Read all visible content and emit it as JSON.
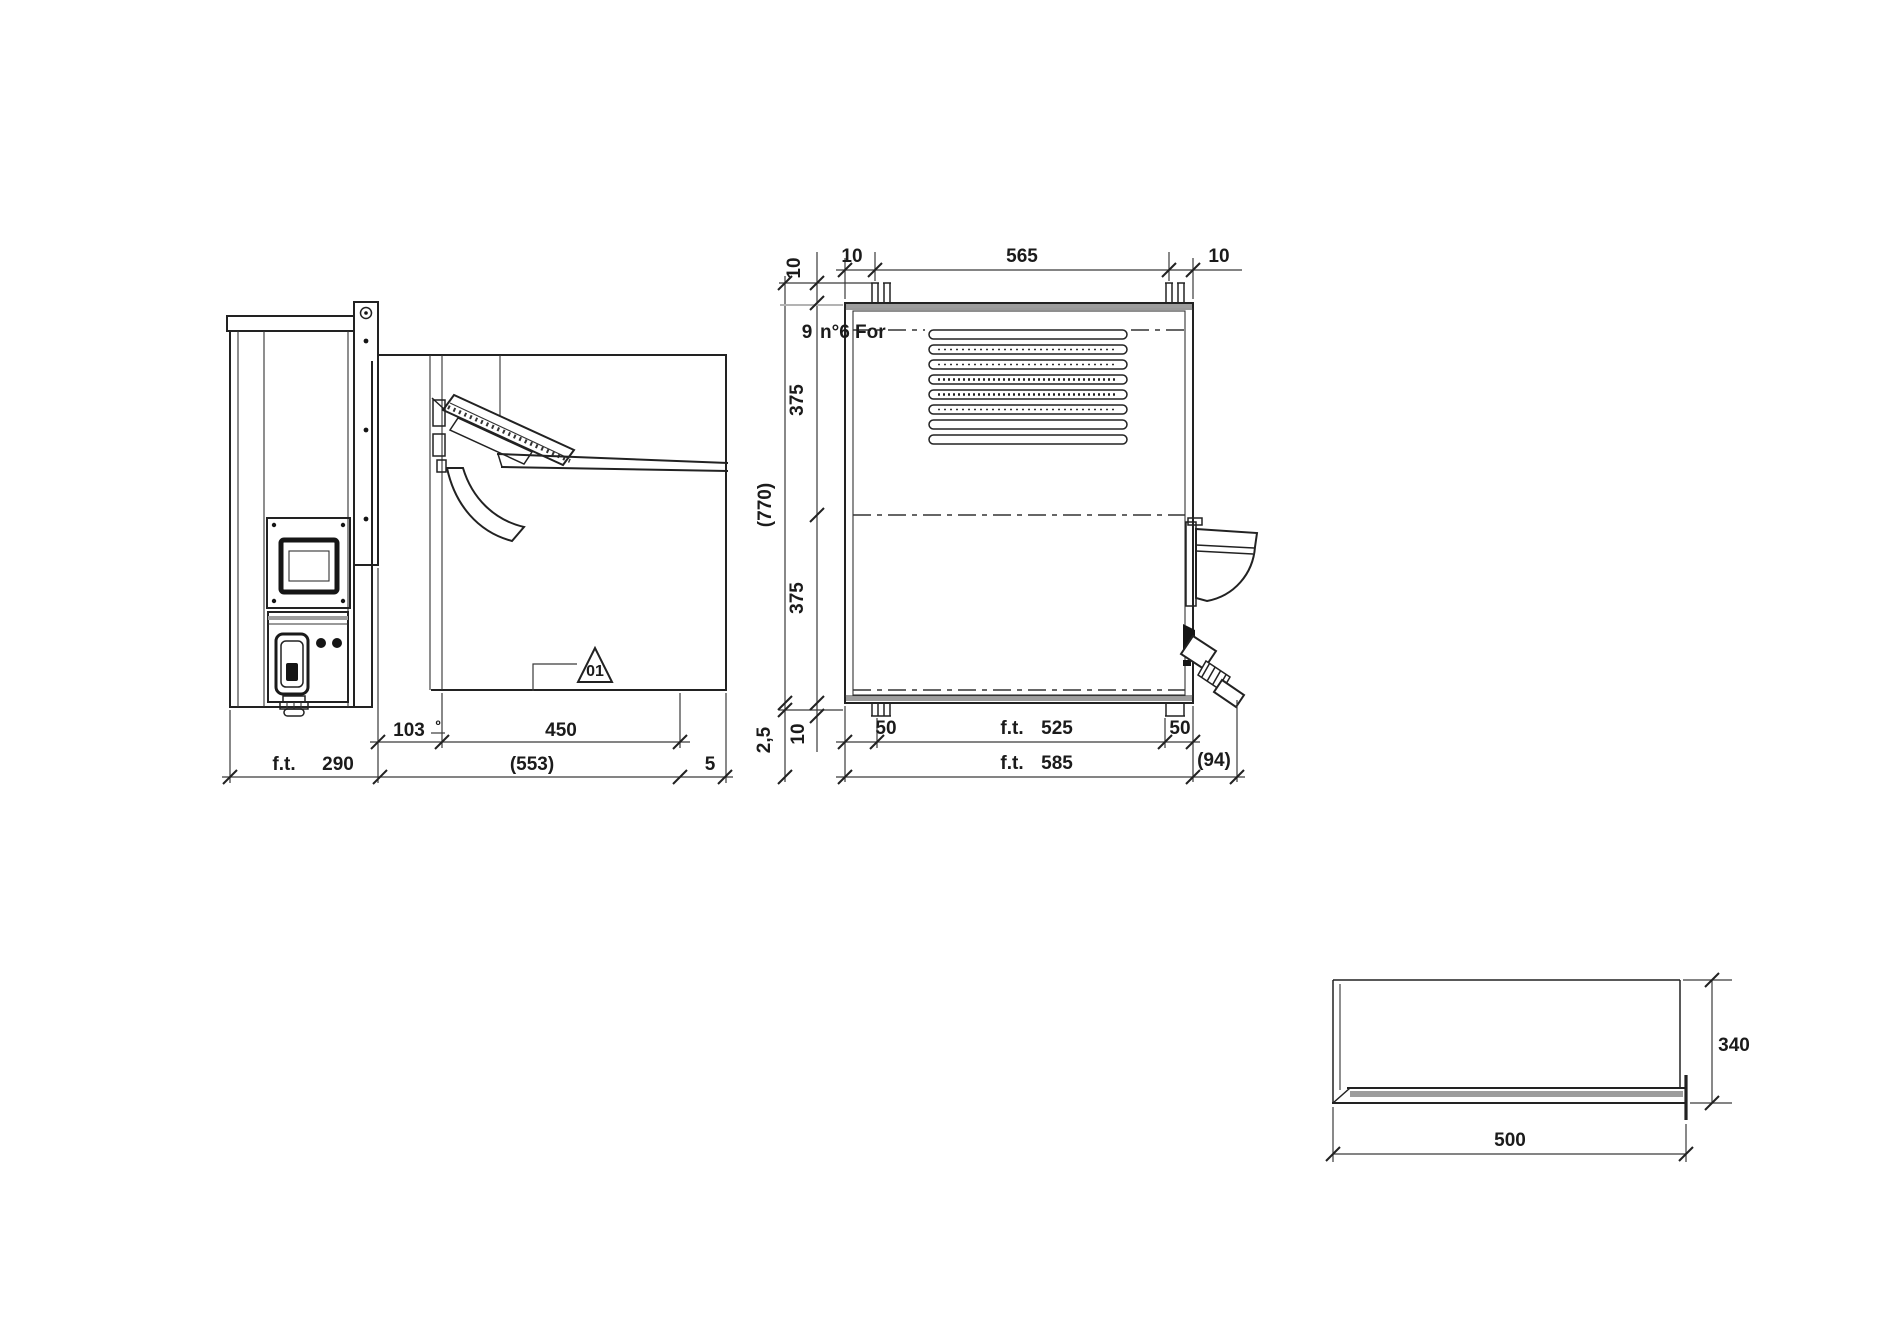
{
  "drawing": {
    "side_view": {
      "ft_label": "f.t.",
      "overall_depth": "290",
      "wall_offset": "103",
      "wall_offset_sup": "º",
      "coil_length": "450",
      "inner_overall": "(553)",
      "edge_gap": "5",
      "revision": "01"
    },
    "rear_view": {
      "top_left_offset": "10",
      "top_width": "565",
      "top_right_offset": "10",
      "rail_height": "10",
      "hole_dia": "9",
      "hole_note": "n°6 For",
      "upper_half": "375",
      "overall_height": "(770)",
      "lower_half": "375",
      "bottom_lip": "2,5",
      "bottom_rail": "10",
      "bottom_left_offset": "50",
      "ft_label_inner": "f.t.",
      "inner_width": "525",
      "bottom_right_offset": "50",
      "ft_label_outer": "f.t.",
      "outer_width": "585",
      "connector_offset": "(94)"
    },
    "panel_view": {
      "height": "340",
      "width": "500"
    }
  }
}
